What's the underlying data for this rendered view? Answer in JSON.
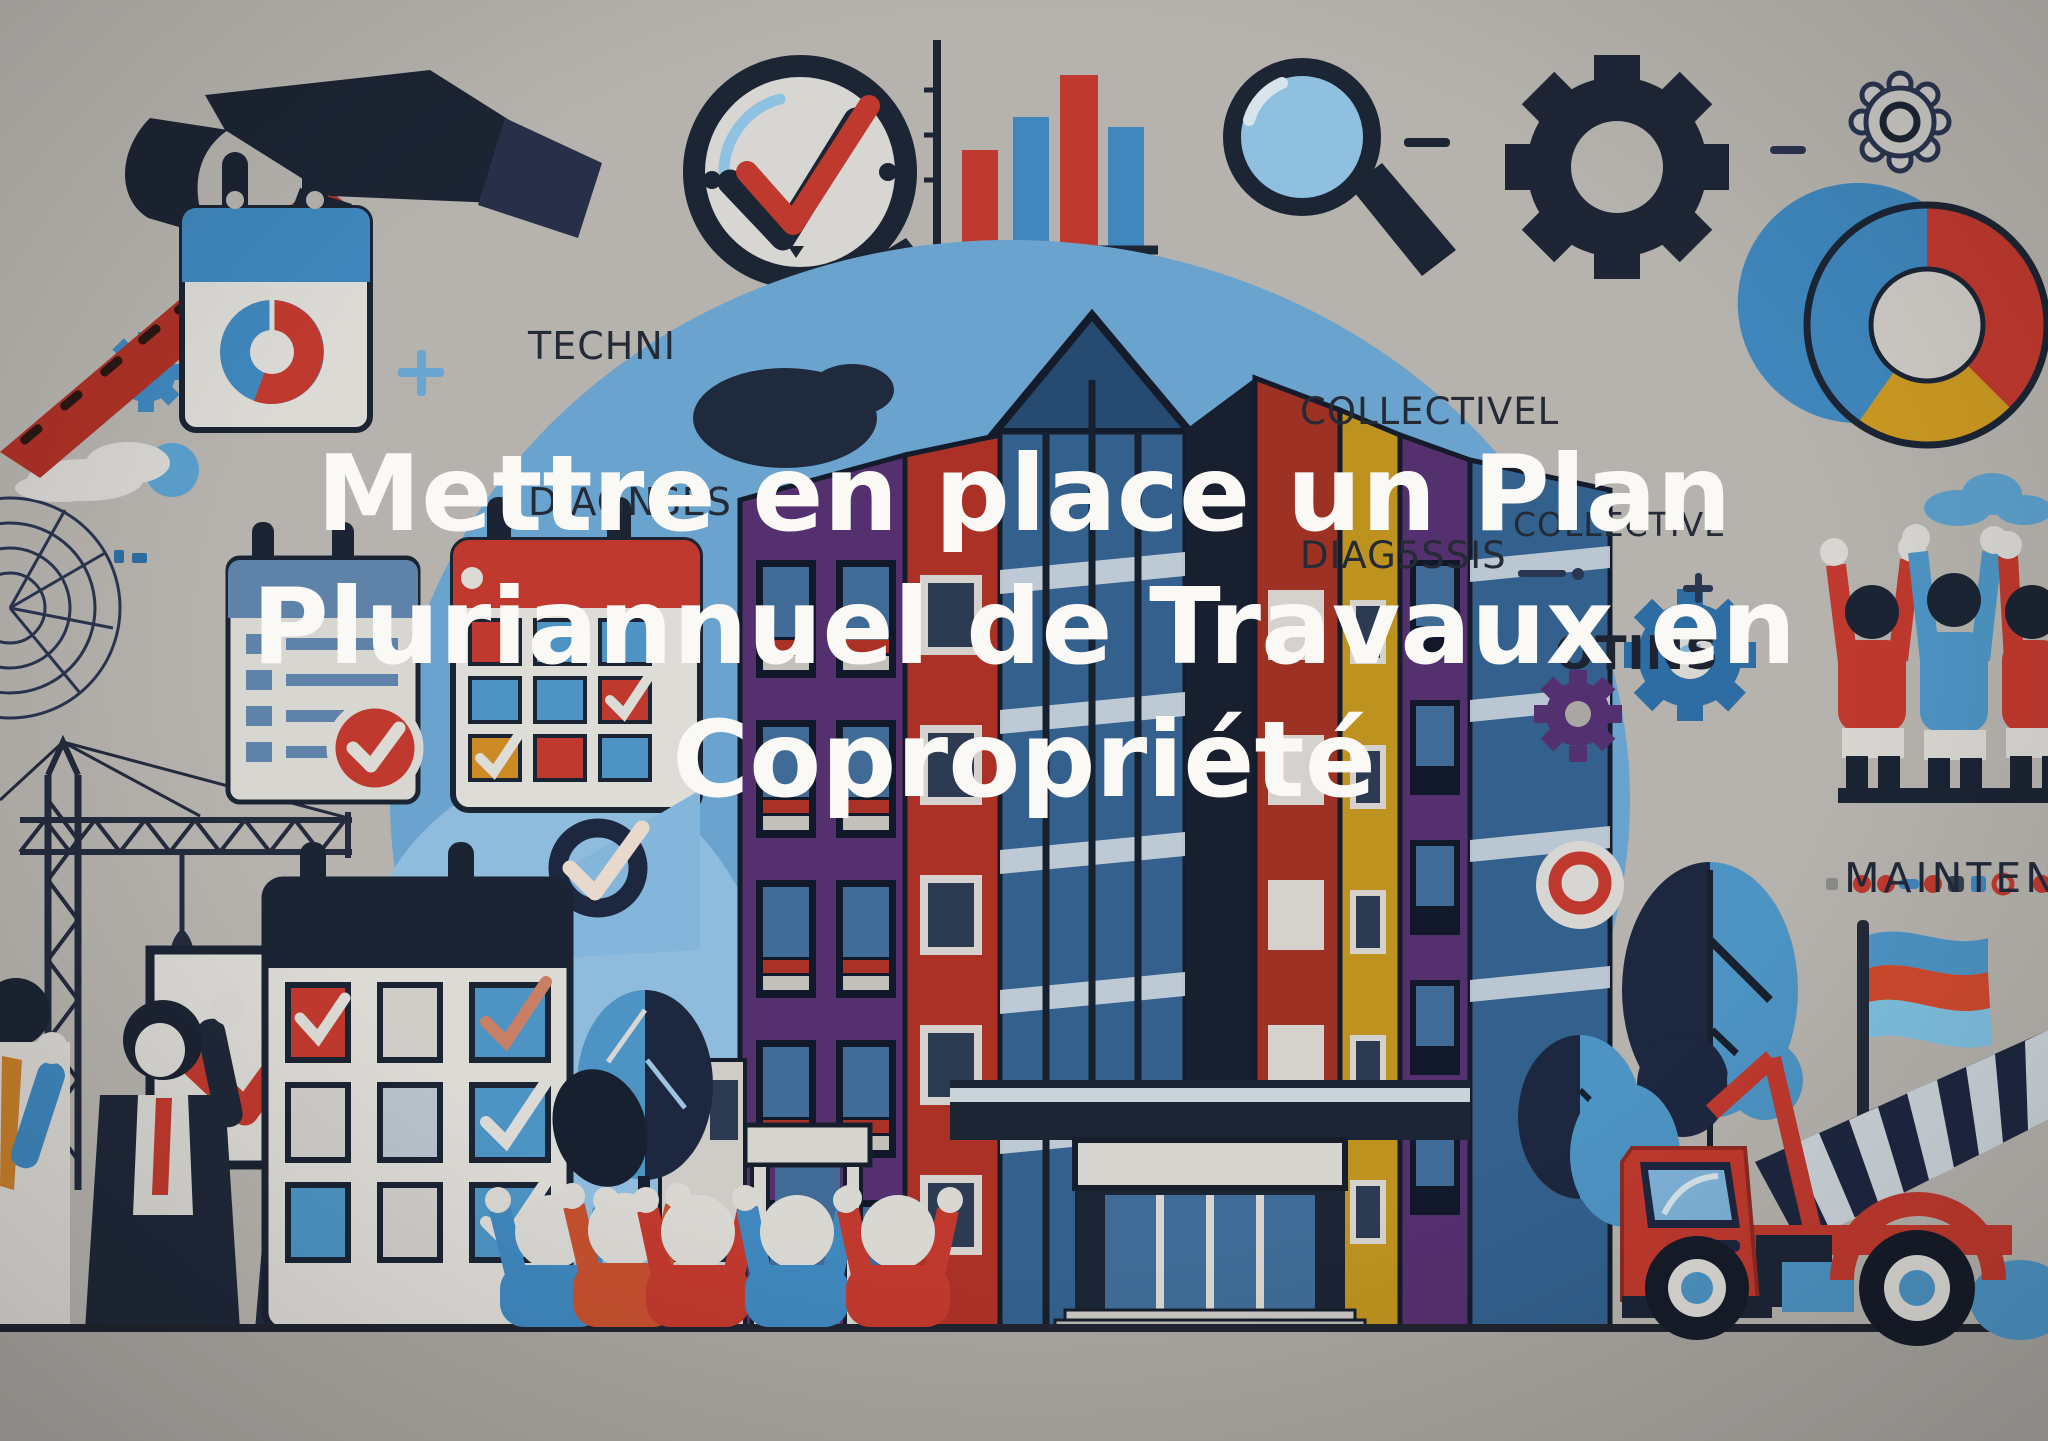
{
  "canvas": {
    "width": 2048,
    "height": 1441,
    "background": "#b6b3ae"
  },
  "title": {
    "lines": [
      "Mettre en place un Plan",
      "Pluriannuel de Travaux en",
      "Copropriété"
    ],
    "color": "#faf9f6"
  },
  "labels": {
    "technical_diagnosis": {
      "line1": "TECHNI",
      "line2": "DIAGNSES"
    },
    "collective_diagnosis": {
      "line1": "COLLECTIVEL",
      "line2": "DIAG5SSIS"
    },
    "collective_partial": {
      "line1": "COLLECTIVE",
      "line2": "OTINS"
    },
    "maintenance": {
      "text": "MAINTENAN"
    }
  },
  "palette": {
    "background": "#b6b3ae",
    "ground_strip": "#a8a5a0",
    "ink": "#242a36",
    "navy": "#1c2433",
    "red": "#c0392e",
    "orange_red": "#c4502f",
    "blue": "#3f87bd",
    "light_blue": "#7fb3d9",
    "sky_blob": "#6ba3cf",
    "purple": "#55306f",
    "maroon": "#9c3124",
    "yellow": "#bd921f",
    "paper": "#dcdad5",
    "title_white": "#faf9f6"
  },
  "icons": [
    "hammer-icon",
    "calendar-pie-icon",
    "magnifier-check-icon",
    "bar-chart-icon",
    "magnifier-icon",
    "big-gear-icon",
    "outline-gear-icon",
    "donut-chart-icon",
    "blue-gear-icon",
    "purple-gear-icon",
    "small-blue-gear-icon",
    "cloud-icon",
    "blueprint-icon",
    "crane-icon",
    "checklist-sign-icon",
    "checklist-calendar-icon",
    "clipboard-check-icon",
    "schedule-calendar-icon",
    "check-badge-icon",
    "tree-icon",
    "flag-icon",
    "cement-truck-icon",
    "people-icon"
  ]
}
